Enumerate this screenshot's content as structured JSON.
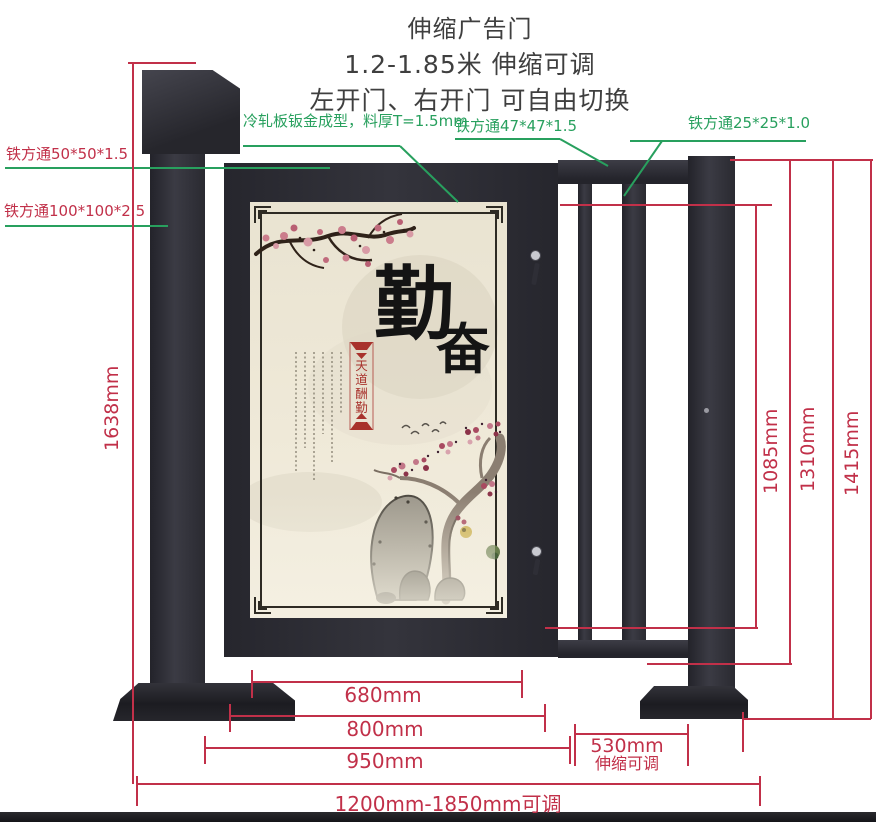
{
  "title": {
    "line1": "伸缩广告门",
    "line2": "1.2-1.85米 伸缩可调",
    "line3": "左开门、右开门 可自由切换"
  },
  "callouts": {
    "sheet_metal": "冷轧板钣金成型，料厚T=1.5mm",
    "tube_47": "铁方通47*47*1.5",
    "tube_25": "铁方通25*25*1.0",
    "tube_50": "铁方通50*50*1.5",
    "tube_100": "铁方通100*100*2.5"
  },
  "dimensions": {
    "total_height": "1638mm",
    "door_height": "1085mm",
    "frame_height": "1310mm",
    "gate_height": "1415mm",
    "poster_width": "680mm",
    "door_width": "800mm",
    "section_width": "950mm",
    "extend_width": "530mm",
    "extend_note": "伸缩可调",
    "total_width": "1200mm-1850mm可调"
  },
  "poster": {
    "calligraphy": [
      "勤",
      "奋"
    ],
    "banner_text": "天道酬勤",
    "banner_chars": [
      "天",
      "道",
      "酬",
      "勤"
    ]
  },
  "colors": {
    "dimension_red": "#c13049",
    "pointer_green": "#28a05e",
    "metal_dark": "#2c2c33",
    "poster_cream": "#ece6d4",
    "banner_red": "#a8322c"
  }
}
